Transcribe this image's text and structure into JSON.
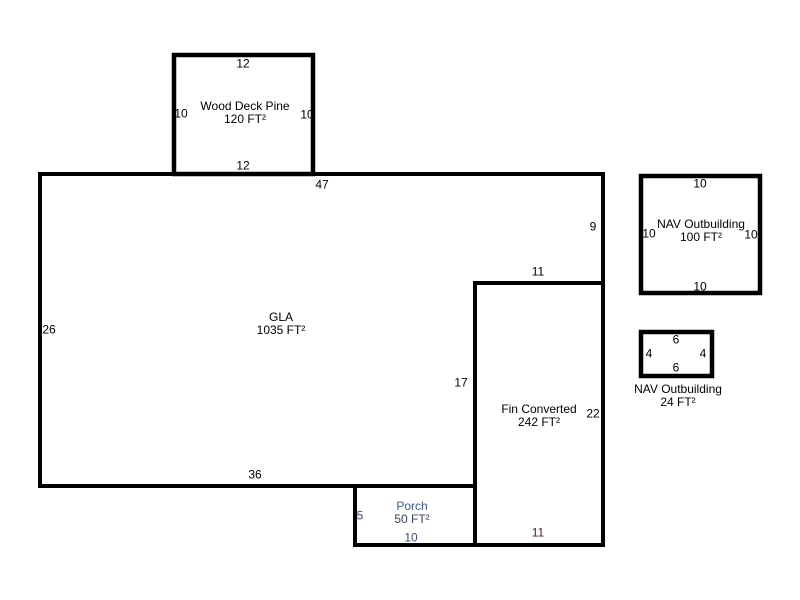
{
  "sketch": {
    "wood_deck": {
      "label_line1": "Wood Deck Pine",
      "label_line2": "120 FT²",
      "dim_top": "12",
      "dim_left": "10",
      "dim_right": "10",
      "dim_bottom": "12"
    },
    "gla": {
      "label_line1": "GLA",
      "label_line2": "1035 FT²",
      "dim_top": "47",
      "dim_right_upper": "9",
      "dim_notch_top": "11",
      "dim_left": "26",
      "dim_notch_side": "17",
      "dim_bottom": "36"
    },
    "fin_converted": {
      "label_line1": "Fin Converted",
      "label_line2": "242 FT²",
      "dim_right": "22",
      "dim_bottom": "11"
    },
    "porch": {
      "label_line1": "Porch",
      "label_line2": "50 FT²",
      "dim_left": "5",
      "dim_bottom": "10"
    },
    "nav_outbuilding_large": {
      "label_line1": "NAV Outbuilding",
      "label_line2": "100 FT²",
      "dim_top": "10",
      "dim_left": "10",
      "dim_right": "10",
      "dim_bottom": "10"
    },
    "nav_outbuilding_small": {
      "label_line1": "NAV Outbuilding",
      "label_line2": "24 FT²",
      "dim_top": "6",
      "dim_left": "4",
      "dim_right": "4",
      "dim_bottom": "6"
    },
    "colors": {
      "wall": "#000000",
      "text": "#000000",
      "porch_text": "#3a5a9c",
      "fin_bottom_dim_text": "#4d1a24",
      "background": "#ffffff"
    }
  }
}
